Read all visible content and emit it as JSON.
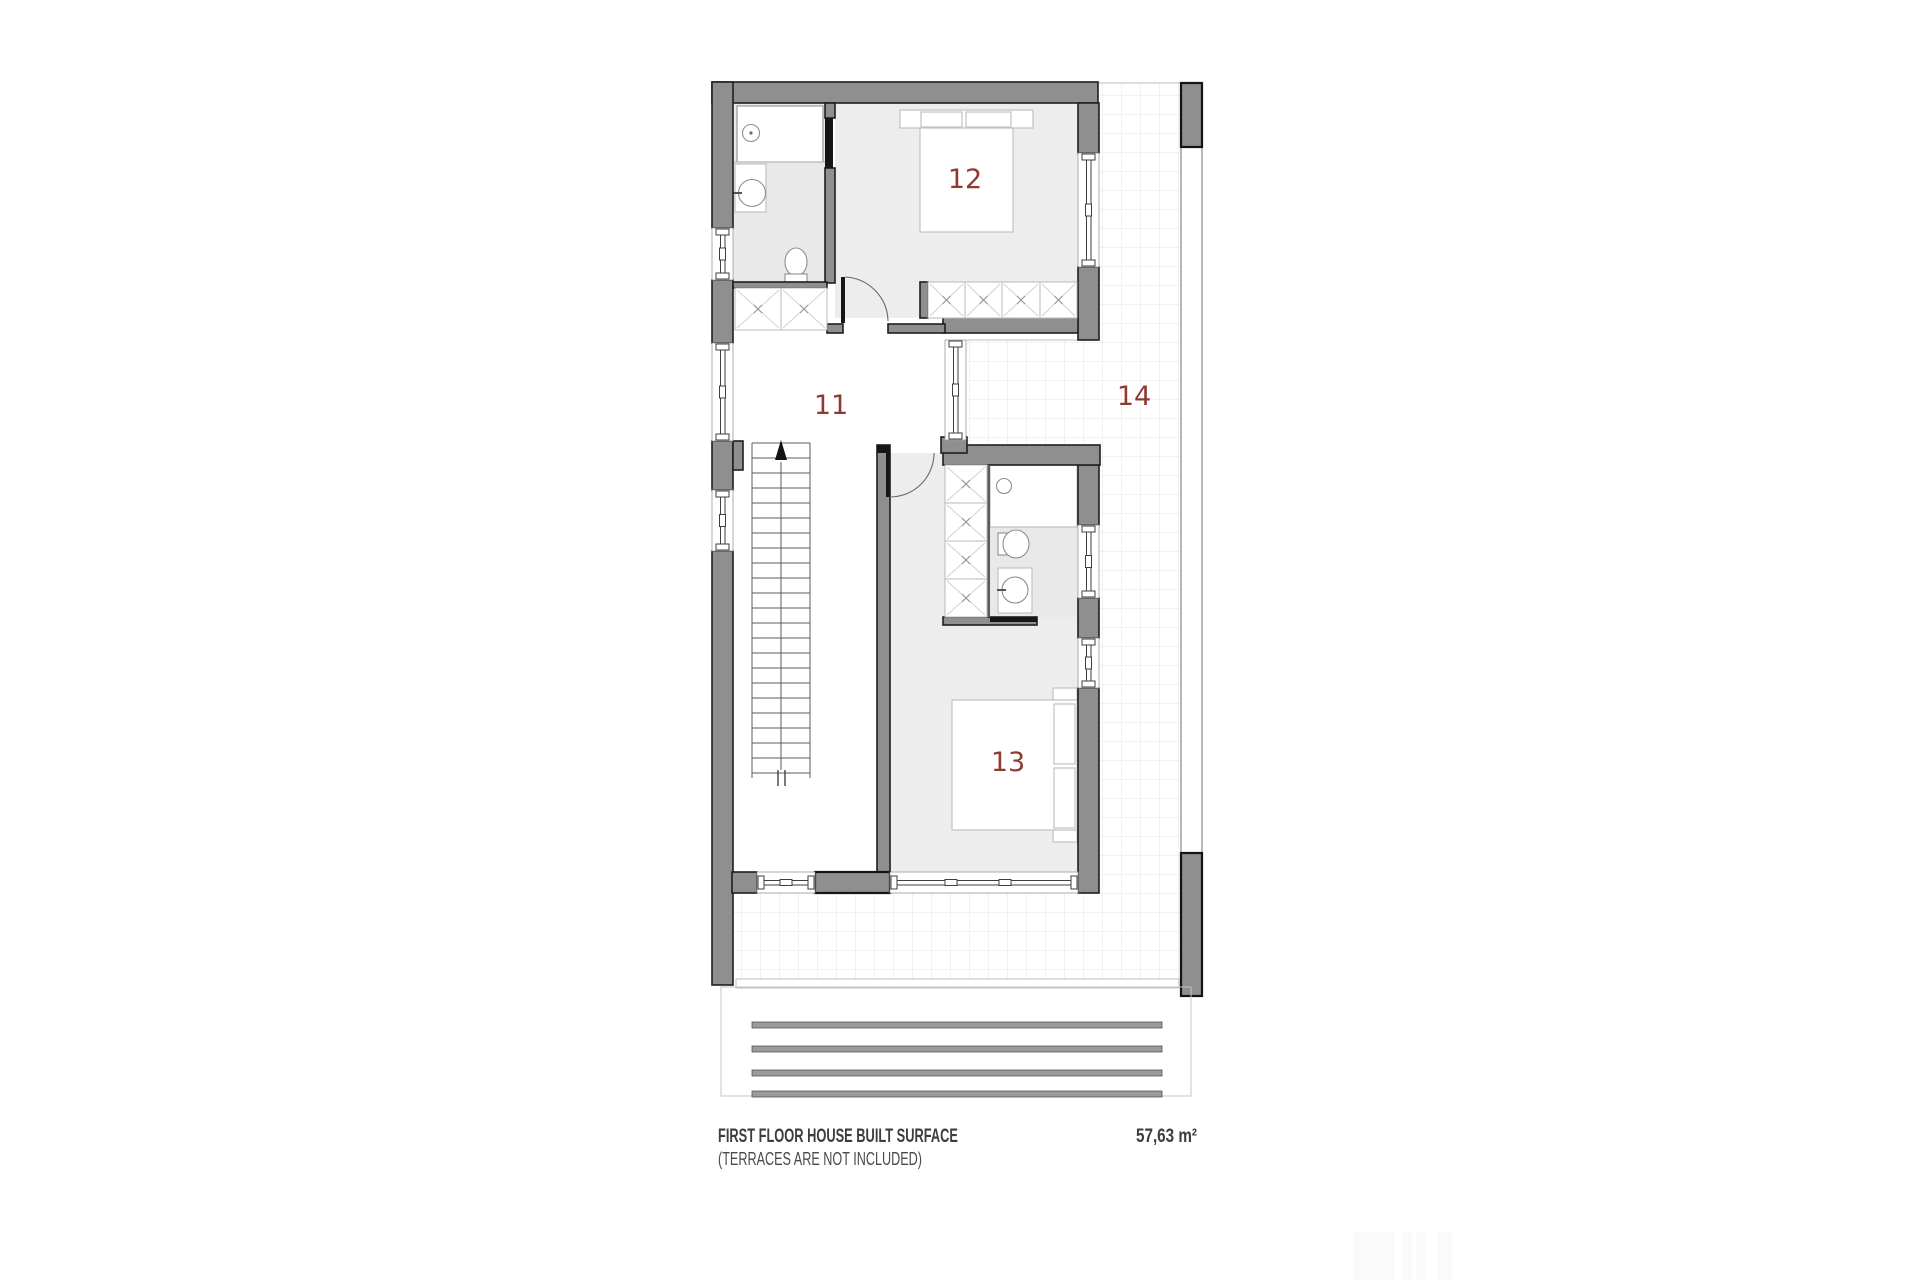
{
  "floor_plan": {
    "labels": {
      "room_11": "11",
      "room_12": "12",
      "room_13": "13",
      "room_14": "14"
    },
    "caption": {
      "title": "FIRST FLOOR HOUSE BUILT SURFACE",
      "note": "(TERRACES ARE NOT INCLUDED)",
      "area_value": "57,63 m²"
    },
    "colors": {
      "wall": "#8f8f8f",
      "wall_outline": "#1f1f1f",
      "room_label": "#8e3a31",
      "floor": "#ededee",
      "tile_line": "#e4e4e4",
      "caption_text": "#3d3d3d"
    }
  }
}
